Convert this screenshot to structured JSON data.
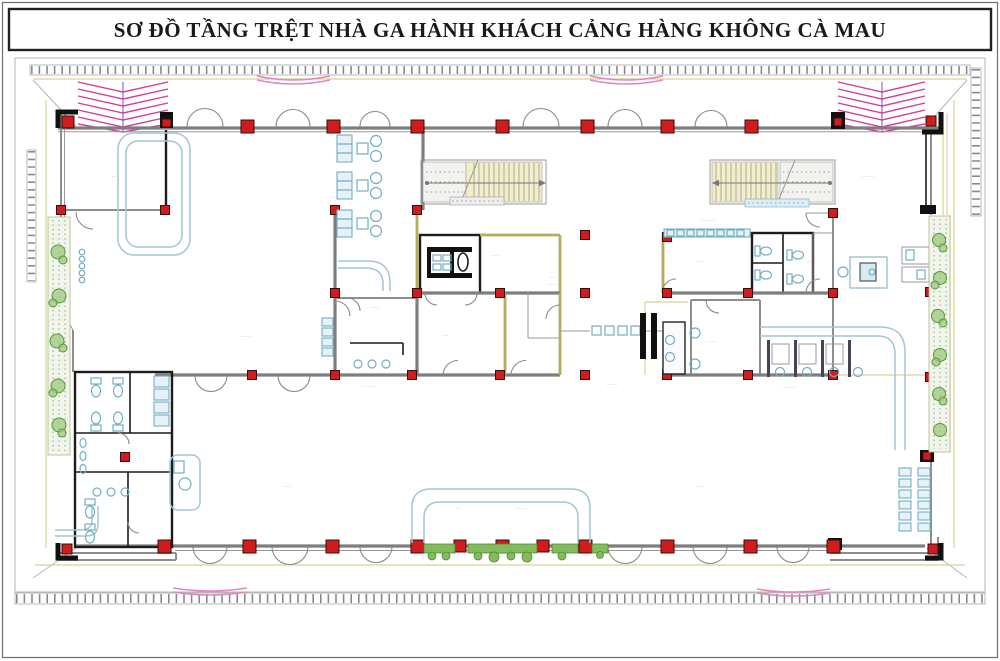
{
  "title": "SƠ ĐỒ TẦNG TRỆT NHÀ GA HÀNH KHÁCH CẢNG HÀNG KHÔNG CÀ MAU",
  "colors": {
    "wall_gray": "#7e7e7e",
    "wall_black": "#1c1c1c",
    "wall_olive": "#b5ad5e",
    "column_red": "#cf1d1d",
    "canopy_magenta": "#cf3f9f",
    "awning_pink": "#e089c0",
    "fixture_cyan": "#74aec4",
    "rail_blue": "#a4c6d2",
    "plant_green": "#59973f",
    "hedge_green": "#83bb5e",
    "pavement_yellow": "#ddd194",
    "site_line": "#b5b5b5"
  },
  "plan": {
    "labels": [
      {
        "x": 114,
        "y": 178,
        "text": "·····"
      },
      {
        "x": 246,
        "y": 338,
        "text": "·······"
      },
      {
        "x": 372,
        "y": 201,
        "text": "·····"
      },
      {
        "x": 446,
        "y": 337,
        "text": "·····"
      },
      {
        "x": 375,
        "y": 309,
        "text": "······"
      },
      {
        "x": 370,
        "y": 388,
        "text": "·········"
      },
      {
        "x": 495,
        "y": 257,
        "text": "·····"
      },
      {
        "x": 552,
        "y": 279,
        "text": "····"
      },
      {
        "x": 552,
        "y": 286,
        "text": "······"
      },
      {
        "x": 612,
        "y": 386,
        "text": "·······"
      },
      {
        "x": 708,
        "y": 222,
        "text": "··········"
      },
      {
        "x": 700,
        "y": 263,
        "text": "······"
      },
      {
        "x": 712,
        "y": 343,
        "text": "·······"
      },
      {
        "x": 810,
        "y": 263,
        "text": "···"
      },
      {
        "x": 789,
        "y": 389,
        "text": "·········"
      },
      {
        "x": 287,
        "y": 488,
        "text": "·····"
      },
      {
        "x": 700,
        "y": 488,
        "text": "·····"
      },
      {
        "x": 458,
        "y": 510,
        "text": "····"
      },
      {
        "x": 521,
        "y": 510,
        "text": "·······"
      },
      {
        "x": 868,
        "y": 178,
        "text": "········"
      }
    ]
  }
}
